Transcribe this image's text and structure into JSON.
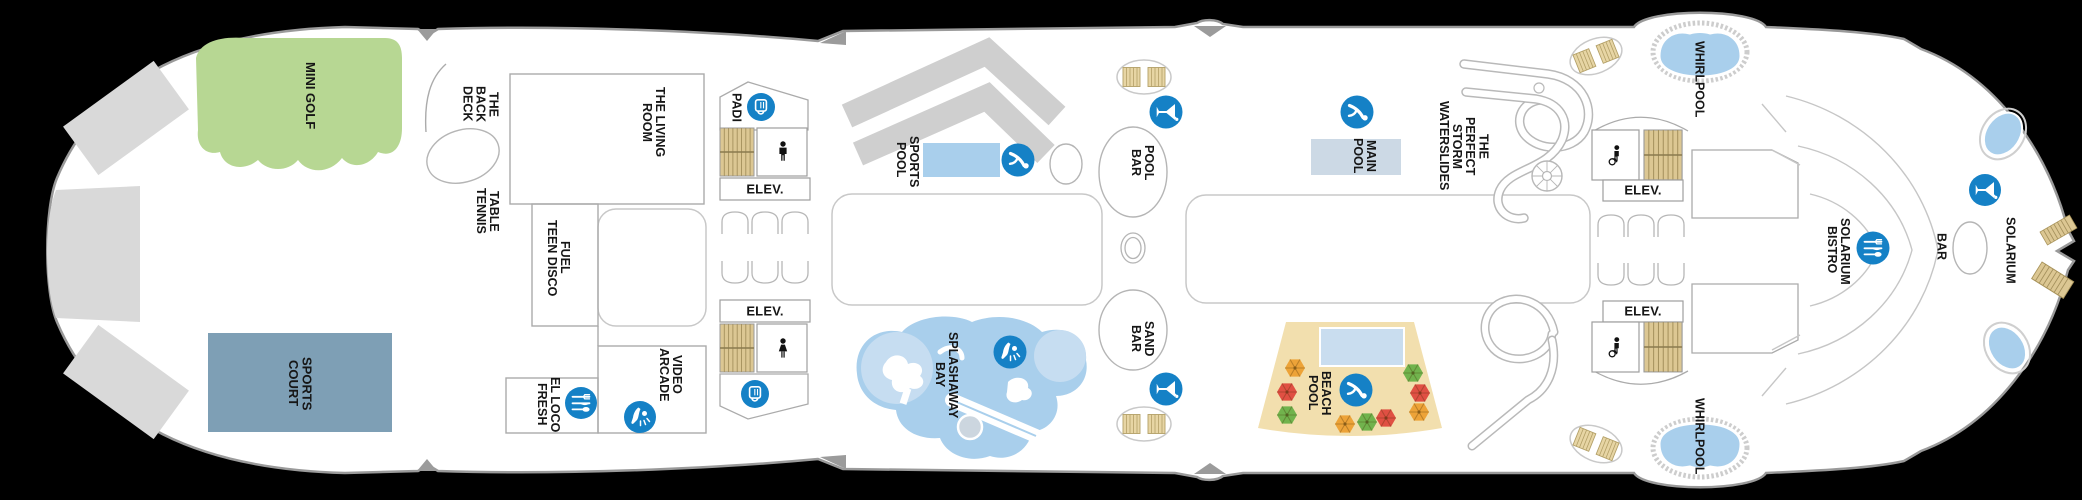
{
  "page": {
    "type": "cruise-ship-deck-plan",
    "orientation": "stern-left-bow-right"
  },
  "colors": {
    "background": "#000000",
    "deck": "#ffffff",
    "hull_outline": "#9a9a9a",
    "icon_blue": "#1581c6",
    "pool_blue": "#a9cfec",
    "pale_pool_blue": "#ccd9e5",
    "mini_golf_green": "#b7d793",
    "sports_court_blue": "#7e9fb5",
    "beach_sand_tan": "#f2dfae",
    "stairs_tan": "#dcc793",
    "structure_gray": "#d9d9d9",
    "umbrella_orange": "#eda338",
    "umbrella_red": "#e05043",
    "umbrella_green": "#71b34d"
  },
  "labels": {
    "mini_golf": [
      "MINI GOLF"
    ],
    "sports_court": [
      "SPORTS",
      "COURT"
    ],
    "back_deck": [
      "THE",
      "BACK",
      "DECK"
    ],
    "table_tennis": [
      "TABLE",
      "TENNIS"
    ],
    "living_room": [
      "THE LIVING",
      "ROOM"
    ],
    "fuel_teen_disco": [
      "FUEL",
      "TEEN DISCO"
    ],
    "el_loco_fresh": [
      "EL LOCO",
      "FRESH"
    ],
    "video_arcade": [
      "VIDEO",
      "ARCADE"
    ],
    "padi": [
      "PADI"
    ],
    "sports_pool": [
      "SPORTS",
      "POOL"
    ],
    "pool_bar": [
      "POOL",
      "BAR"
    ],
    "sand_bar": [
      "SAND",
      "BAR"
    ],
    "splashaway_bay": [
      "SPLASHAWAY",
      "BAY"
    ],
    "main_pool": [
      "MAIN",
      "POOL"
    ],
    "perfect_storm": [
      "THE",
      "PERFECT",
      "STORM",
      "WATERSLIDES"
    ],
    "beach_pool": [
      "BEACH",
      "POOL"
    ],
    "whirlpool": [
      "WHIRLPOOL"
    ],
    "solarium_bistro": [
      "SOLARIUM",
      "BISTRO"
    ],
    "bar": [
      "BAR"
    ],
    "solarium": [
      "SOLARIUM"
    ],
    "elevator": "ELEV."
  },
  "icons": {
    "shop": "shopping-bag",
    "dining": "fork-knife-spoon",
    "bar": "martini-glass",
    "pool": "diver",
    "water_play": "splash-figure",
    "restroom_men": "man-figure",
    "restroom_women": "woman-figure",
    "restroom_accessible": "wheelchair-figure",
    "stairs": "striped-steps",
    "spiral_stairs": "spiral",
    "umbrella": "hex-parasol",
    "lounge_chairs": "striped-pair"
  }
}
